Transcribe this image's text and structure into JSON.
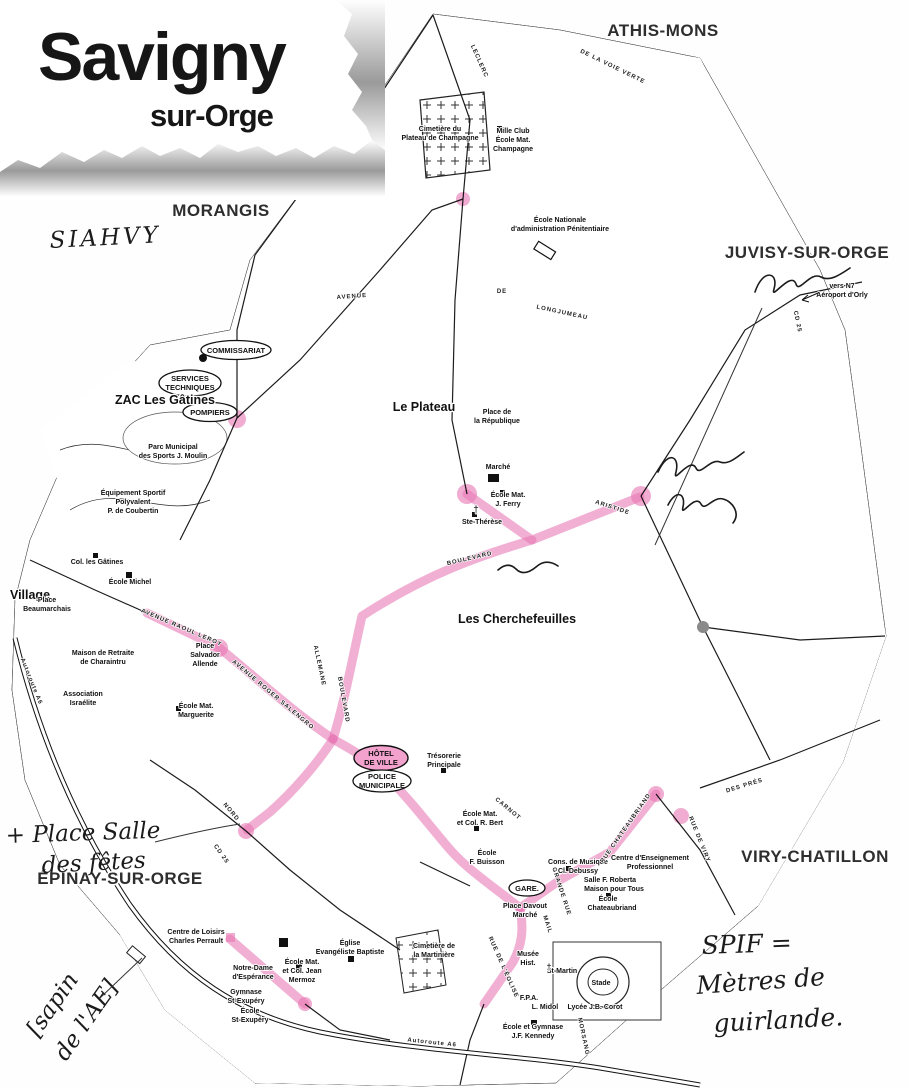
{
  "logo": {
    "title": "Savigny",
    "subtitle": "sur-Orge"
  },
  "communes": {
    "athis": "ATHIS-MONS",
    "morangis": "MORANGIS",
    "juvisy": "JUVISY-SUR-ORGE",
    "viry": "VIRY-CHATILLON",
    "epinay": "ÉPINAY-SUR-ORGE"
  },
  "districts": {
    "plateau": "Le Plateau",
    "cherchefeuilles": "Les Cherchefeuilles",
    "zac": "ZAC Les Gâtines",
    "village": "Village"
  },
  "ellipses": {
    "commissariat": "COMMISSARIAT",
    "services": [
      "SERVICES",
      "TECHNIQUES"
    ],
    "pompiers": "POMPIERS",
    "hdv": [
      "HÔTEL",
      "DE VILLE"
    ],
    "police": [
      "POLICE",
      "MUNICIPALE"
    ],
    "gare": "GARE."
  },
  "pois": {
    "cim_champagne": [
      "Cimetière du",
      "Plateau de Champagne"
    ],
    "mille_club": [
      "Mille Club",
      "École Mat.",
      "Champagne"
    ],
    "enap": [
      "École Nationale",
      "d'administration Pénitentiaire"
    ],
    "parc_moulin": [
      "Parc Municipal",
      "des Sports J. Moulin"
    ],
    "coubertin": [
      "Équipement Sportif",
      "Polyvalent",
      "P. de Coubertin"
    ],
    "republique": [
      "Place de",
      "la République"
    ],
    "marche": "Marché",
    "ecole_ferry": [
      "École Mat.",
      "J. Ferry"
    ],
    "ste_therese": "Ste-Thérèse",
    "tresorerie": [
      "Trésorerie",
      "Principale"
    ],
    "ecole_bert": [
      "École Mat.",
      "et Col. R. Bert"
    ],
    "ecole_buisson": [
      "École",
      "F. Buisson"
    ],
    "cons_musique": [
      "Cons. de Musique",
      "Cl. Debussy"
    ],
    "centre_ens": [
      "Centre d'Enseignement",
      "Professionnel"
    ],
    "salle_roberta": "Salle F. Roberta",
    "maison_tous": "Maison pour Tous",
    "ecole_chateaubriand": [
      "École",
      "Chateaubriand"
    ],
    "place_davout": [
      "Place Davout",
      "Marché"
    ],
    "cim_martiniere": [
      "Cimetière de",
      "la Martinière"
    ],
    "musee": [
      "Musée",
      "Hist."
    ],
    "st_martin": "St-Martin",
    "stade": "Stade",
    "fpa": "F.P.A.",
    "midol": "L. Midol",
    "corot": "Lycée J.B. Corot",
    "kennedy": [
      "École et Gymnase",
      "J.F. Kennedy"
    ],
    "perrault": [
      "Centre de Loisirs",
      "Charles Perrault"
    ],
    "notre_dame": [
      "Notre-Dame",
      "d'Espérance"
    ],
    "mermoz": [
      "École Mat.",
      "et Col. Jean",
      "Mermoz"
    ],
    "gym_exupery": [
      "Gymnase",
      "St-Exupéry"
    ],
    "ecole_exupery": [
      "École",
      "St-Exupéry"
    ],
    "eglise_baptiste": [
      "Église",
      "Evangéliste Baptiste"
    ],
    "retraite": [
      "Maison de Retraite",
      "de Charaintru"
    ],
    "israelite": [
      "Association",
      "Israélite"
    ],
    "ecole_michel": "École Michel",
    "col_gatines": "Col. les Gâtines",
    "beaumarchais": [
      "Place",
      "Beaumarchais"
    ],
    "allende": [
      "Place",
      "Salvador",
      "Allende"
    ],
    "marguerite": [
      "École Mat.",
      "Marguerite"
    ],
    "vers_n7": [
      "vers N7",
      "Aéroport d'Orly"
    ]
  },
  "streets": {
    "leclerc": "LECLERC",
    "voie_verte": "DE LA VOIE VERTE",
    "avenue": "AVENUE",
    "de": "DE",
    "longjumeau": "LONGJUMEAU",
    "aristide": "ARISTIDE",
    "boulevard": "BOULEVARD",
    "salengro": "AVENUE ROGER SALENGRO",
    "raoul": "AVENUE RAOUL LEROY",
    "blvd_vert": "BOULEVARD",
    "allemane": "ALLEMANE",
    "nord": "NORD",
    "cd25": "CD 25",
    "cd25b": "CD 25",
    "grande_rue": "GRANDE RUE",
    "mail": "MAIL",
    "eglise": "RUE DE L'ÉGLISE",
    "chateaubriand": "RUE CHATEAUBRIAND",
    "viry": "RUE DE VIRY",
    "pres": "DES PRÉS",
    "carnot": "CARNOT",
    "morsang": "MORSANG",
    "a6": "Autoroute A6",
    "a6b": "Autoroute A6"
  },
  "annotations": {
    "siahvy": "SIAHVY",
    "place_salle": [
      "+ Place Salle",
      "des fêtes"
    ],
    "sapin": [
      "[sapin",
      "de l'AE]"
    ],
    "spif": [
      "SPIF =",
      "Mètres de",
      "guirlande."
    ]
  },
  "colors": {
    "highlight": "#e879b5",
    "ink": "#1b1b1b"
  }
}
